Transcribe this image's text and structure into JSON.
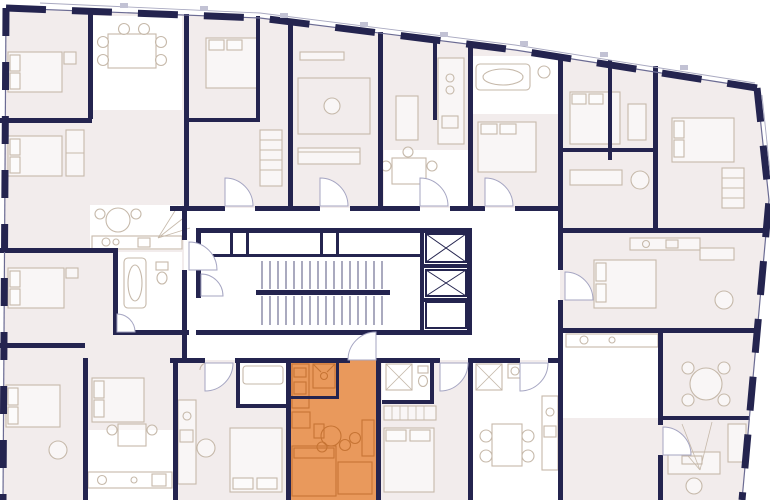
{
  "scene": {
    "kind": "architectural-floor-plan",
    "description": "Residential floor plan, one studio unit highlighted in orange, central core with staircase and two elevators",
    "highlighted_unit": {
      "name": "selected-unit",
      "location": "bottom-center",
      "type": "studio",
      "rooms": [
        "kitchen",
        "shower-room",
        "living-sleeping-area"
      ]
    },
    "core": {
      "has_staircase": true,
      "elevator_count": 2
    }
  },
  "colors": {
    "wall": "#24244f",
    "room_fill": "#f2ecec",
    "white_room": "#ffffff",
    "furniture": "#c6b9aa",
    "glass": "#6b6b93",
    "door": "#a5a5c2",
    "highlight": "#e9995c",
    "highlight_line": "#c67434",
    "stair": "#56567f",
    "parapet": "#a9a9c0",
    "tick": "#c2c2d4"
  },
  "icons": {
    "elevator": "elevator-shaft-x-icon",
    "stairs": "staircase-icon",
    "door": "door-swing-icon"
  }
}
